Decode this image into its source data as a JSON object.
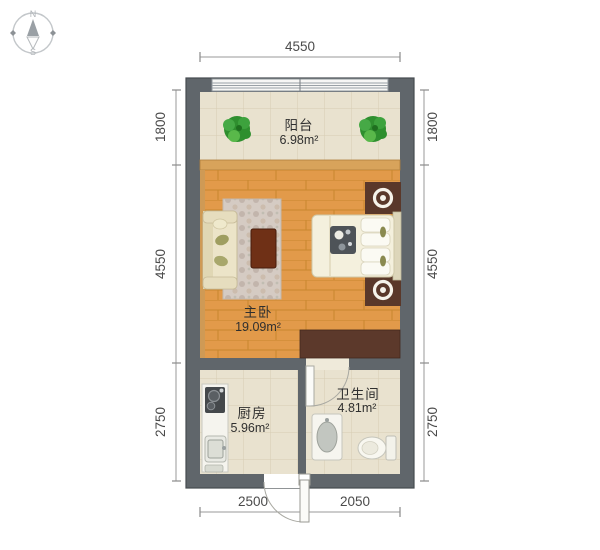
{
  "compass": {
    "north": "N",
    "south": "S"
  },
  "dimensions": {
    "top": "4550",
    "bottom": {
      "left_segment": "2500",
      "right_segment": "2050"
    },
    "left": [
      "1800",
      "4550",
      "2750"
    ],
    "right": [
      "1800",
      "4550",
      "2750"
    ]
  },
  "rooms": {
    "balcony": {
      "name": "阳台",
      "area": "6.98m²"
    },
    "master_bedroom": {
      "name": "主卧",
      "area": "19.09m²"
    },
    "kitchen": {
      "name": "厨房",
      "area": "5.96m²"
    },
    "bathroom": {
      "name": "卫生间",
      "area": "4.81m²"
    }
  },
  "icons": {
    "compass": "compass-rose-icon",
    "plant": "potted-plant-icon",
    "lamp": "bedside-lamp-icon",
    "stove": "stove-icon",
    "sink": "kitchen-sink-icon",
    "basin": "washbasin-icon",
    "toilet": "toilet-icon",
    "door": "door-swing-icon",
    "window": "window-icon"
  },
  "colors": {
    "wall": "#60666b",
    "wood_floor": "#e29a4a",
    "tile_floor": "#e9e2cf",
    "window_sill": "#d8a35b",
    "wardrobe": "#5c392b",
    "nightstand": "#5a382a",
    "coffee_table": "#6f3016",
    "plant_green": "#3b9e3b",
    "dimension_text": "#4b4b4b",
    "room_label_text": "#2f2f2f"
  }
}
